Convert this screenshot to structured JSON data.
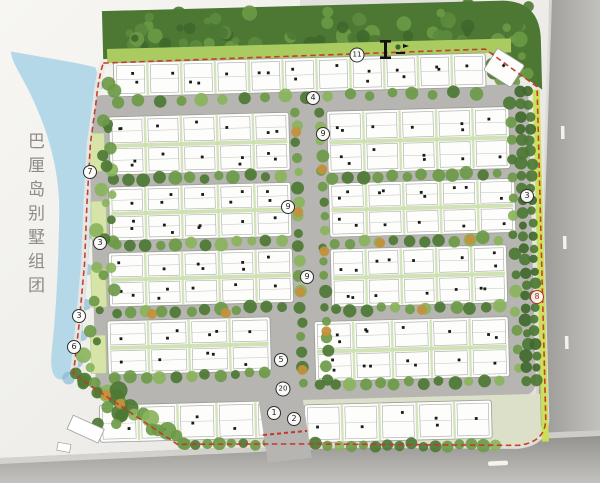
{
  "plan": {
    "title": {
      "text": "巴厘岛别墅组团"
    },
    "markers": [
      {
        "label": "11",
        "x": 357,
        "y": 55,
        "variant": "default"
      },
      {
        "label": "4",
        "x": 313,
        "y": 98,
        "variant": "default"
      },
      {
        "label": "9",
        "x": 323,
        "y": 134,
        "variant": "default"
      },
      {
        "label": "9",
        "x": 288,
        "y": 207,
        "variant": "default"
      },
      {
        "label": "9",
        "x": 307,
        "y": 277,
        "variant": "default"
      },
      {
        "label": "3",
        "x": 527,
        "y": 196,
        "variant": "default"
      },
      {
        "label": "8",
        "x": 537,
        "y": 297,
        "variant": "red"
      },
      {
        "label": "7",
        "x": 90,
        "y": 172,
        "variant": "default"
      },
      {
        "label": "3",
        "x": 100,
        "y": 243,
        "variant": "default"
      },
      {
        "label": "3",
        "x": 79,
        "y": 316,
        "variant": "default"
      },
      {
        "label": "6",
        "x": 74,
        "y": 347,
        "variant": "default"
      },
      {
        "label": "5",
        "x": 281,
        "y": 360,
        "variant": "default"
      },
      {
        "label": "20",
        "x": 283,
        "y": 389,
        "variant": "default"
      },
      {
        "label": "1",
        "x": 274,
        "y": 413,
        "variant": "default"
      },
      {
        "label": "2",
        "x": 294,
        "y": 419,
        "variant": "default"
      }
    ],
    "icons": [
      {
        "name": "section-cut-icon"
      },
      {
        "name": "entrance-flag-icon"
      }
    ]
  },
  "palette": {
    "paper": "#f0efeb",
    "road_outer_dark": "#8d8c89",
    "road_outer_light": "#c2c1bd",
    "road_inner": "#b6b5b1",
    "curb": "#dedcd6",
    "water": "#b5d8e8",
    "water_deep": "#83b7d5",
    "tree_dark": "#4d7834",
    "tree_mid": "#6c9a46",
    "tree_light": "#8ab45c",
    "lawn": "#a9cb60",
    "lawn_stripe": "#cadf52",
    "ground": "#dce0c9",
    "parking": "#d6e4a8",
    "villa_fill": "#fdfdfc",
    "villa_stroke": "#9b9b97",
    "hedge": "#ccdfae",
    "boundary_red": "#c5372a",
    "tree_orange": "#c2913d",
    "dot": "#1a1a1a"
  }
}
